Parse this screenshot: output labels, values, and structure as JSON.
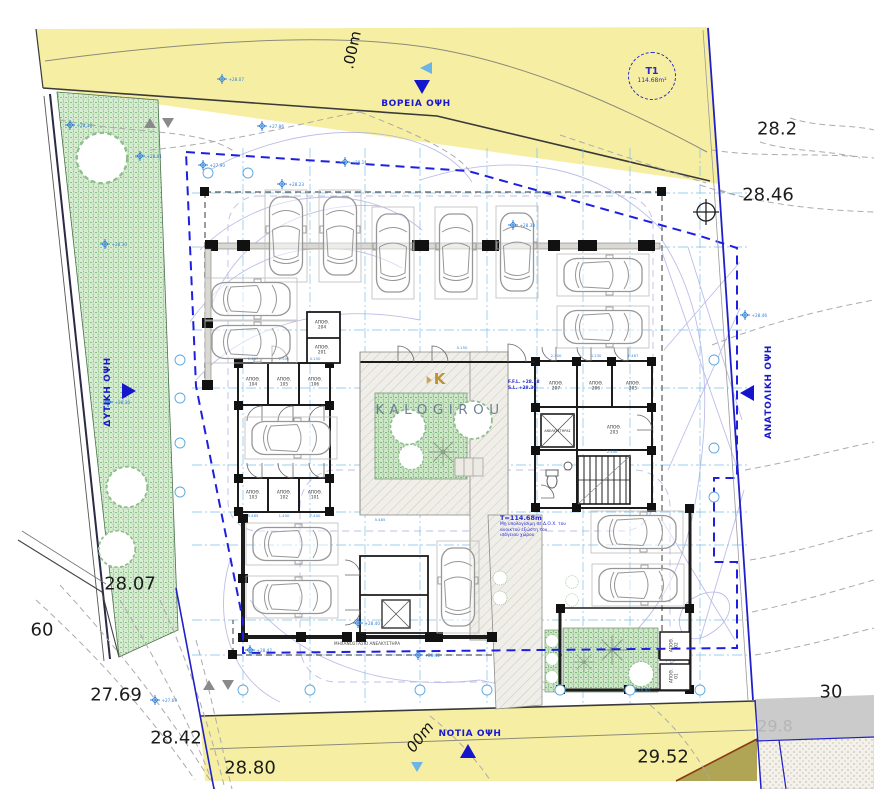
{
  "facades": {
    "north": "ΒΟΡΕΙΑ ΟΨΗ",
    "south": "ΝΟΤΙΑ ΟΨΗ",
    "west": "ΔΥΤΙΚΗ ΟΨΗ",
    "east": "ΑΝΑΤΟΛΙΚΗ ΟΨΗ"
  },
  "plot_badge": {
    "id": "T1",
    "area": "114.68m²"
  },
  "road_labels": {
    "top": ".00m",
    "bottom": "00m"
  },
  "elevations": {
    "ne_upper": "28.2",
    "ne_corner": "28.46",
    "west_strip": "28.07",
    "far_left": "60",
    "southwest_upper": "27.69",
    "southwest": "28.42",
    "south_left": "28.80",
    "south_right": "29.52",
    "southeast": "30",
    "southeast_gray": "29.8"
  },
  "watermark": {
    "brand": "KALOGIROU",
    "monogram": "K"
  },
  "area_note": {
    "title": "T=114.68m",
    "lines": [
      "Μη υπολογίσιμη σε Δ.Ο.Χ. του",
      "ανοικτού εξώστη του",
      "ισόγειου χώρου"
    ]
  },
  "level_note": {
    "line1": "F.F.L. +28.38",
    "line2": "S.L. +28.30"
  },
  "elevator_label": "ΑΝΕΛΚΥΣΤΗΡΑΣ",
  "machine_note": "ΜΗΧΑΝΟΣΤΑΣΙΟ ΑΝΕΛΚΥΣΤΗΡΑ",
  "rooms": [
    {
      "label": "ΑΠΟΘ.",
      "num": "104"
    },
    {
      "label": "ΑΠΟΘ.",
      "num": "105"
    },
    {
      "label": "ΑΠΟΘ.",
      "num": "106"
    },
    {
      "label": "ΑΠΟΘ.",
      "num": "103"
    },
    {
      "label": "ΑΠΟΘ.",
      "num": "102"
    },
    {
      "label": "ΑΠΟΘ.",
      "num": "101"
    },
    {
      "label": "ΑΠΟΘ.",
      "num": "204"
    },
    {
      "label": "ΑΠΟΘ.",
      "num": "201"
    },
    {
      "label": "ΑΠΟΘ.",
      "num": "207"
    },
    {
      "label": "ΑΠΟΘ.",
      "num": "206"
    },
    {
      "label": "ΑΠΟΘ.",
      "num": "205"
    },
    {
      "label": "ΑΠΟΘ.",
      "num": "203"
    },
    {
      "label": "ΑΠΟΘ.",
      "num": "02"
    },
    {
      "label": "ΑΠΟΘ.",
      "num": "01"
    }
  ],
  "spot_levels": [
    "+28.38",
    "+28.01",
    "+28.07",
    "+27.86",
    "+28.11",
    "+27.90",
    "+28.23",
    "+28.38",
    "+28.30",
    "+28.30",
    "+28.46",
    "+28.80",
    "+28.42",
    "+28.40",
    "+28.42",
    "+27.69"
  ],
  "dims": [
    "1.487",
    "2.500",
    "0.150",
    "5.485",
    "1.400",
    "7.400",
    "2.300",
    "0.230"
  ],
  "colors": {
    "accent_blue": "#2020c8",
    "dashed_blue": "#1f1fe0",
    "cyan": "#6fb6e6",
    "road_yellow": "#f6efa3",
    "green": "#8cc08a",
    "gold": "#c09135"
  }
}
